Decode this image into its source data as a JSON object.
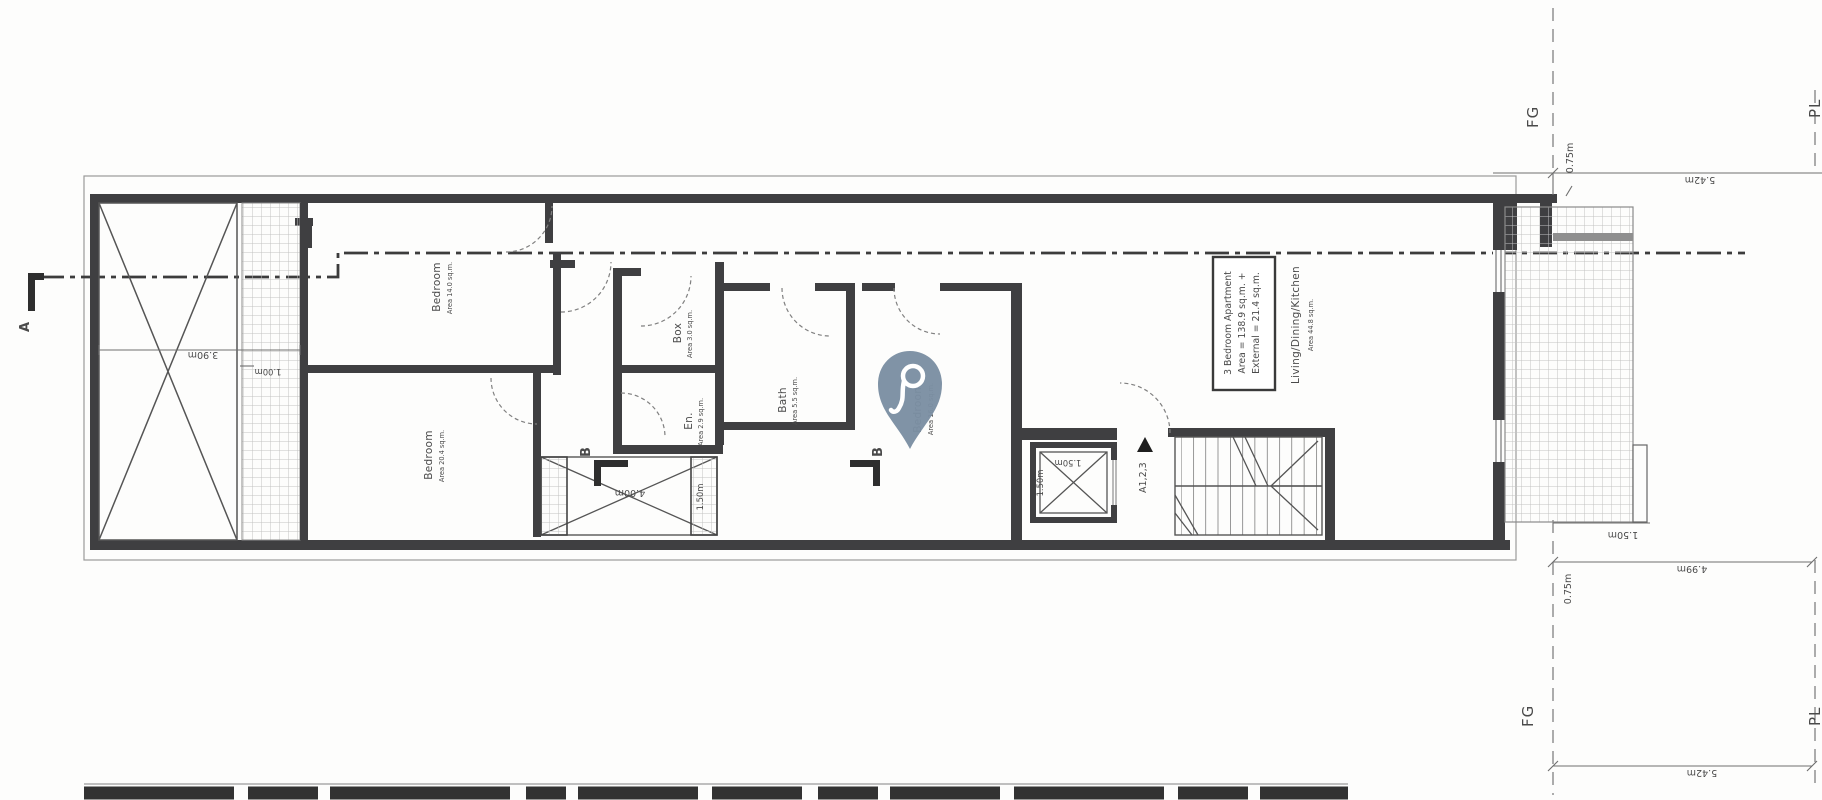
{
  "labels": {
    "section_a": "A",
    "section_b_left": "B",
    "section_b_right": "B",
    "grid_fg_top": "FG",
    "grid_fg_bottom": "FG",
    "grid_pl_top": "PL",
    "grid_pl_bottom": "PL",
    "apartment_ref": "A1,2,3"
  },
  "rooms": [
    {
      "name": "Bedroom",
      "area": "Area 14.0 sq.m."
    },
    {
      "name": "Bedroom",
      "area": "Area 20.4 sq.m."
    },
    {
      "name": "Box",
      "area": "Area 3.0 sq.m."
    },
    {
      "name": "En.",
      "area": "Area 2.9 sq.m."
    },
    {
      "name": "Bath",
      "area": "Area 5.5 sq.m."
    },
    {
      "name": "Bedroom",
      "area": "Area 16.0 sq.m."
    },
    {
      "name": "Living/Dining/Kitchen",
      "area": "Area 44.8 sq.m."
    }
  ],
  "info_box": {
    "line1": "3 Bedroom Apartment",
    "line2": "Area = 138.9 sq.m. +",
    "line3": "External = 21.4 sq.m."
  },
  "dims": {
    "left_width": "3.90m",
    "left_offset": "1.00m",
    "shaft_length": "4.00m",
    "shaft_width": "1.50m",
    "lift_width": "1.50m",
    "lift_depth": "1.50m",
    "terrace_step": "1.50m",
    "top_offset": "0.75m",
    "top_span": "5.42m",
    "bottom_span1": "4.99m",
    "bottom_offset": "0.75m",
    "bottom_span2": "5.42m"
  },
  "colors": {
    "pin": "#7B8FA2",
    "wall": "#3F3F41",
    "line": "#6E6E6E",
    "hatch": "#BDBDBD",
    "text": "#4A4A4A"
  }
}
